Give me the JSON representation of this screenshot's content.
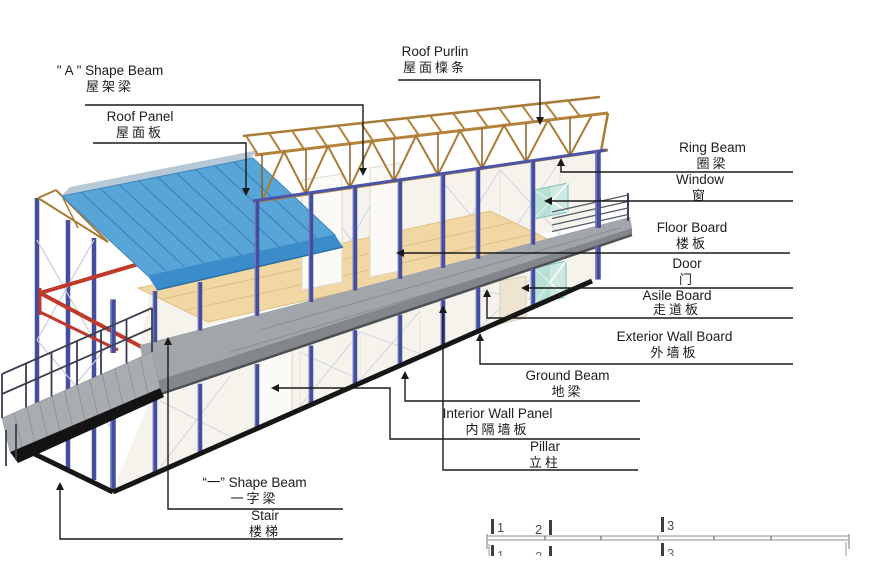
{
  "figure": {
    "labels": {
      "a_shape_beam": {
        "en": "\" A \" Shape Beam",
        "cn": "屋架梁"
      },
      "roof_panel": {
        "en": "Roof Panel",
        "cn": "屋面板"
      },
      "roof_purlin": {
        "en": "Roof Purlin",
        "cn": "屋面檁条"
      },
      "ring_beam": {
        "en": "Ring Beam",
        "cn": "圈梁"
      },
      "window": {
        "en": "Window",
        "cn": "窗"
      },
      "floor_board": {
        "en": "Floor Board",
        "cn": "楼板"
      },
      "door": {
        "en": "Door",
        "cn": "门"
      },
      "asile_board": {
        "en": "Asile Board",
        "cn": "走道板"
      },
      "exterior_wall_board": {
        "en": "Exterior Wall Board",
        "cn": "外墙板"
      },
      "ground_beam": {
        "en": "Ground Beam",
        "cn": "地梁"
      },
      "interior_wall_panel": {
        "en": "Interior Wall Panel",
        "cn": "内隔墙板"
      },
      "pillar": {
        "en": "Pillar",
        "cn": "立柱"
      },
      "one_shape_beam": {
        "en": "“一” Shape Beam",
        "cn": "一字梁"
      },
      "stair": {
        "en": "Stair",
        "cn": "楼梯"
      }
    },
    "scale_marks": [
      "1",
      "2",
      "3"
    ],
    "colors": {
      "roof_blue": "#58A5D8",
      "roof_edge_blue": "#3B8CCB",
      "purlin_brown": "#B5823C",
      "pillar_blue": "#454E9C",
      "beam_red": "#C0392B",
      "walkway_gray": "#A2A6AA",
      "window_teal": "#CDE9E1",
      "floor_tan": "#F1D7A4",
      "wall_cream": "#F5F3EC",
      "ground_black": "#161616"
    }
  }
}
